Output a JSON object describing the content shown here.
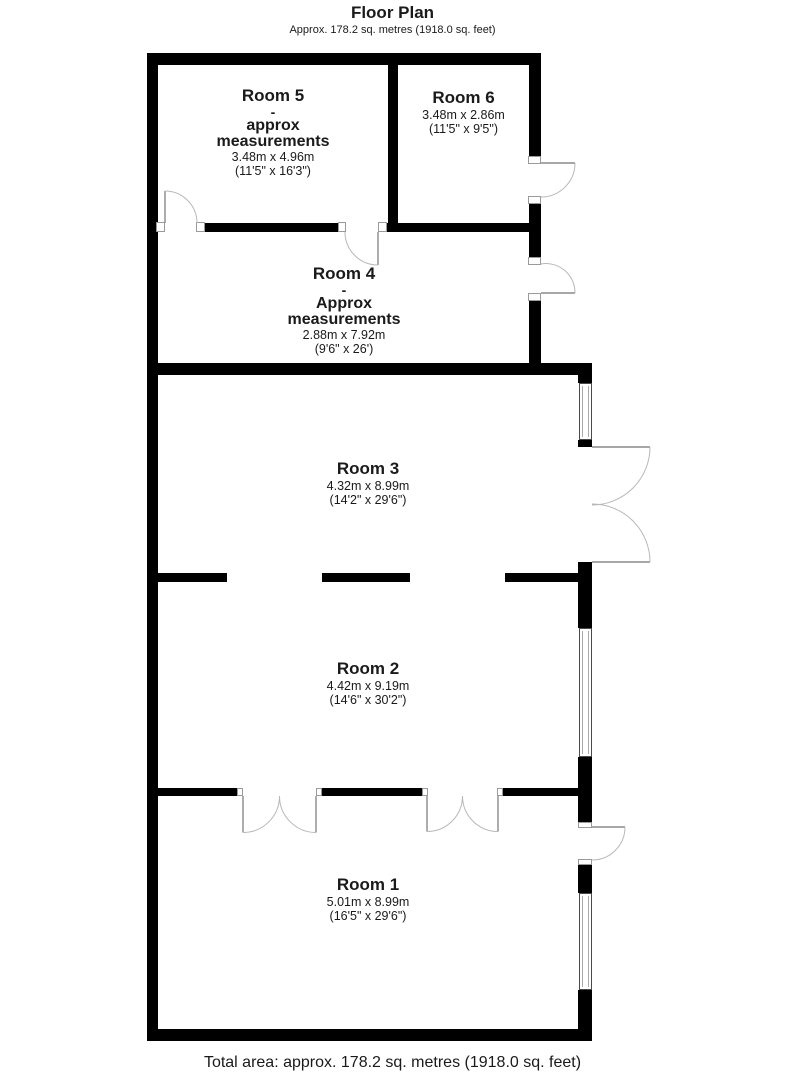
{
  "header": {
    "title": "Floor Plan",
    "subtitle": "Approx. 178.2 sq. metres (1918.0 sq. feet)"
  },
  "rooms": [
    {
      "name": "Room 1",
      "metric": "5.01m x 8.99m",
      "imperial": "(16'5\" x 29'6\")"
    },
    {
      "name": "Room 2",
      "metric": "4.42m x 9.19m",
      "imperial": "(14'6\" x 30'2\")"
    },
    {
      "name": "Room 3",
      "metric": "4.32m x 8.99m",
      "imperial": "(14'2\" x 29'6\")"
    },
    {
      "name": "Room 4",
      "dash": "-",
      "approx_label": "Approx",
      "measurements_label": "measurements",
      "metric": "2.88m x 7.92m",
      "imperial": "(9'6\" x 26')"
    },
    {
      "name": "Room 5",
      "dash": "-",
      "approx_label": "approx",
      "measurements_label": "measurements",
      "metric": "3.48m x 4.96m",
      "imperial": "(11'5\" x 16'3\")"
    },
    {
      "name": "Room 6",
      "metric": "3.48m x 2.86m",
      "imperial": "(11'5\" x 9'5\")"
    }
  ],
  "footer": {
    "total_area": "Total area: approx. 178.2 sq. metres (1918.0 sq. feet)"
  },
  "colors": {
    "wall": "#000000",
    "door_arc": "#b8b8b8",
    "door_leaf": "#8a8a8a",
    "background": "#ffffff"
  }
}
